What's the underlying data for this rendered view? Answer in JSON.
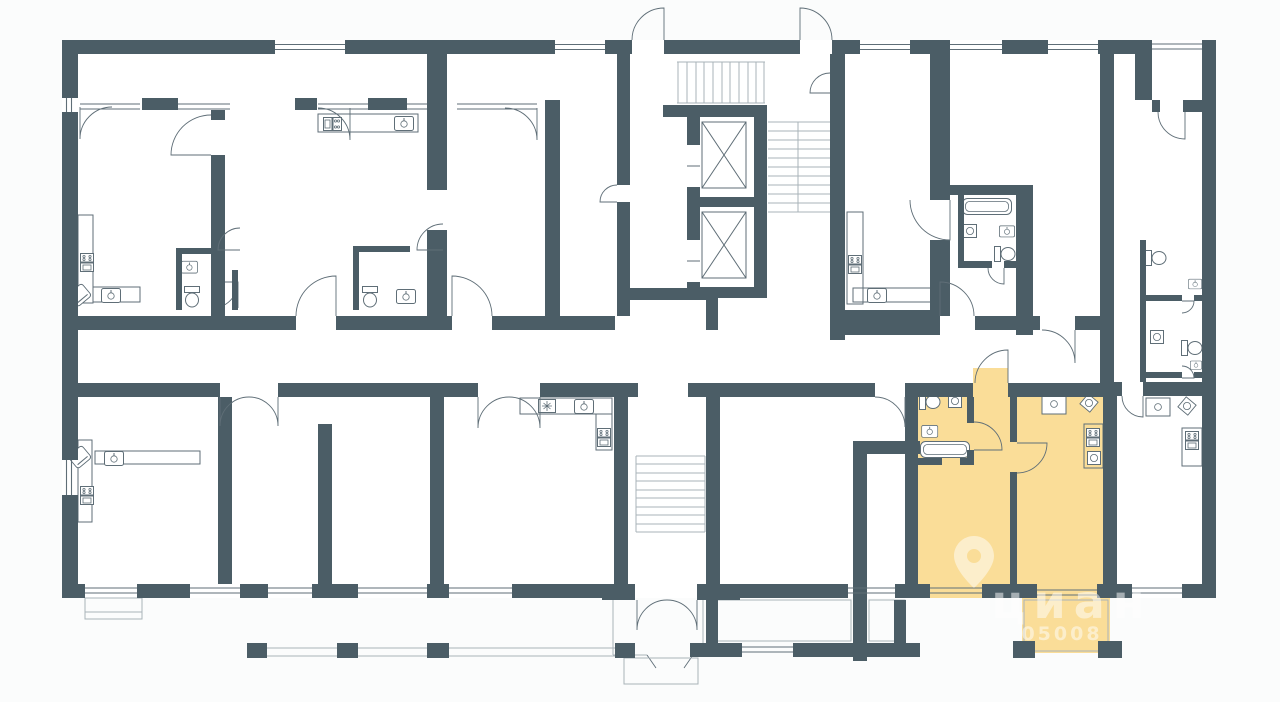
{
  "page": {
    "background": "#fbfcfc",
    "kind": "residential-floor-plan-image"
  },
  "colors": {
    "pagebg": "#fbfcfc",
    "wall": "#4b5d66",
    "room": "#ffffff",
    "highlight": "#fadd98",
    "fixture": "#5f6e77",
    "light": "#a9b3b9",
    "watermark": "#ffffff"
  },
  "watermark": {
    "brand": "циан",
    "code": "05008",
    "icon": "location-pin-icon"
  },
  "plan": {
    "highlighted_unit": {
      "position": "bottom-right",
      "fill": "#fadd98",
      "rooms": [
        "hallway",
        "bathroom",
        "bedroom",
        "kitchen-living room",
        "balcony"
      ]
    },
    "core": {
      "elevators": 2,
      "staircases": 3
    },
    "features": [
      "corridor",
      "entrance-vestibule",
      "colonnade-loggia",
      "balconies",
      "apartment-fixtures"
    ]
  }
}
